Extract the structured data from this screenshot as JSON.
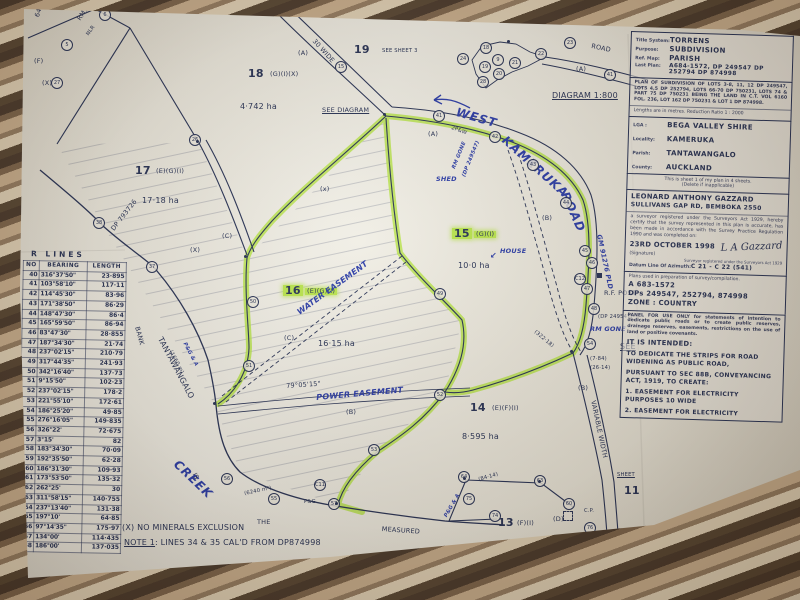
{
  "colors": {
    "ink": "#232e52",
    "pen": "#2638a6",
    "highlight": "#b9e54a",
    "paper": "#edeadf",
    "fabric_dark": "#473628",
    "fabric_tan": "#c8ad8b"
  },
  "title_block": {
    "fields": [
      {
        "label": "Title System:",
        "value": "TORRENS"
      },
      {
        "label": "Purpose:",
        "value": "SUBDIVISION"
      },
      {
        "label": "Ref. Map:",
        "value": "PARISH"
      },
      {
        "label": "Last Plan:",
        "value": "A684-1572, DP 249547 DP 252794  DP 874998"
      }
    ],
    "plan_of_subdivision": "PLAN OF SUBDIVISION OF LOTS 3-8, 11, 12 DP 249547, LOTS 4,5 DP 252794, LOTS 66-70 DP 750231, LOTS 74 & PART 75 DP 750231 BEING THE LAND IN C.T. VOL 6160 FOL. 236, LOT 162 DP 750231 & LOT 1 DP 874998.",
    "lengths_note": "Lengths are in metres.   Reduction Ratio 1 : 2000",
    "admin": [
      {
        "label": "LGA :",
        "value": "BEGA VALLEY SHIRE"
      },
      {
        "label": "Locality:",
        "value": "KAMERUKA"
      },
      {
        "label": "Parish:",
        "value": "TANTAWANGALO"
      },
      {
        "label": "County:",
        "value": "AUCKLAND"
      }
    ],
    "sheet_note": "This is sheet 1 of my plan in 4 sheets.",
    "sheet_note2": "(Delete if inapplicable)",
    "surveyor_name": "LEONARD ANTHONY GAZZARD",
    "surveyor_address": "SULLIVANS GAP RD, BEMBOKA 2550",
    "certification": "a surveyor registered under the Surveyors Act 1929, hereby certify that the survey represented in this plan is accurate, has been made in accordance with the Survey Practice Regulation 1990 and was completed on:",
    "survey_date": "23RD OCTOBER 1998",
    "signature": "L A Gazzard",
    "signature_caption": "(Signature)",
    "registered_note": "Surveyor registered under the Surveyors Act 1929",
    "datum_label": "Datum Line Of Azimuth:",
    "datum_value": "C 21 - C 22 (541)",
    "plans_used_label": "Plans used in preparation of survey/compilation.",
    "plans_used_1": "A 683-1572",
    "plans_used_2": "DPs 249547, 252794, 874998",
    "plans_used_3": "ZONE : COUNTRY",
    "panel_note": "PANEL FOR USE ONLY for statements of intention to dedicate public roads or to create public reserves, drainage reserves, easements, restrictions on the use of land or positive covenants.",
    "intended_title": "IT IS INTENDED:",
    "intended_1": "TO DEDICATE THE STRIPS FOR ROAD WIDENING AS PUBLIC ROAD,",
    "intended_2": "PURSUANT TO SEC 88B, CONVEYANCING ACT, 1919, TO CREATE:",
    "intended_3": "1. EASEMENT FOR ELECTRICITY PURPOSES 10 WIDE",
    "intended_4": "2. EASEMENT FOR ELECTRICITY"
  },
  "lines_table": {
    "title": "R  LINES",
    "columns": [
      "NO",
      "BEARING",
      "LENGTH"
    ],
    "rows": [
      [
        "40",
        "316°37'50\"",
        "23·895"
      ],
      [
        "41",
        "103°58'10\"",
        "117·11"
      ],
      [
        "42",
        "114°45'30\"",
        "83·96"
      ],
      [
        "43",
        "171°38'50\"",
        "86·29"
      ],
      [
        "44",
        "148°47'30\"",
        "86·4"
      ],
      [
        "45",
        "165°59'50\"",
        "86·94"
      ],
      [
        "46",
        "83°47'30\"",
        "28·855"
      ],
      [
        "47",
        "187°34'30\"",
        "21·74"
      ],
      [
        "48",
        "237°02'15\"",
        "210·79"
      ],
      [
        "49",
        "317°44'35\"",
        "241·93"
      ],
      [
        "50",
        "342°16'40\"",
        "137·73"
      ],
      [
        "51",
        "9°15'50\"",
        "102·23"
      ],
      [
        "52",
        "237°02'15\"",
        "178·2"
      ],
      [
        "53",
        "221°55'10\"",
        "172·61"
      ],
      [
        "54",
        "186°25'20\"",
        "49·85"
      ],
      [
        "55",
        "276°16'05\"",
        "149·835"
      ],
      [
        "56",
        "326°22'",
        "72·675"
      ],
      [
        "57",
        "3°15'",
        "82"
      ],
      [
        "58",
        "183°34'30\"",
        "70·09"
      ],
      [
        "59",
        "192°35'50\"",
        "62·28"
      ],
      [
        "60",
        "186°31'30\"",
        "109·93"
      ],
      [
        "61",
        "173°53'50\"",
        "135·32"
      ],
      [
        "62",
        "262°25'",
        "30"
      ],
      [
        "63",
        "311°58'15\"",
        "140·755"
      ],
      [
        "64",
        "237°13'40\"",
        "131·38"
      ],
      [
        "65",
        "197°10'",
        "64·85"
      ],
      [
        "66",
        "97°14'35\"",
        "175·97"
      ],
      [
        "67",
        "134°00'",
        "114·435"
      ],
      [
        "68",
        "186°00'",
        "137·035"
      ]
    ]
  },
  "map": {
    "labels": [
      {
        "t": "6449",
        "x": 34,
        "y": 16,
        "r": -72,
        "c": "sm"
      },
      {
        "t": "RM1",
        "x": 76,
        "y": 18,
        "r": -55,
        "c": "sm"
      },
      {
        "t": "NLR",
        "x": 86,
        "y": 34,
        "r": -55,
        "c": "xs"
      },
      {
        "t": "(F)",
        "x": 34,
        "y": 58,
        "c": "sm"
      },
      {
        "t": "(X)",
        "x": 42,
        "y": 80,
        "c": "sm"
      },
      {
        "t": "19",
        "x": 354,
        "y": 44,
        "c": "big",
        "n": "lot-19-label"
      },
      {
        "t": "SEE SHEET 3",
        "x": 382,
        "y": 49,
        "c": "xs"
      },
      {
        "t": "18",
        "x": 248,
        "y": 68,
        "c": "big",
        "n": "lot-18-label"
      },
      {
        "t": "(G)(I)(X)",
        "x": 270,
        "y": 71,
        "c": "sm"
      },
      {
        "t": "4·742 ha",
        "x": 240,
        "y": 103,
        "c": "md",
        "n": "lot-18-area"
      },
      {
        "t": "SEE DIAGRAM",
        "x": 322,
        "y": 107,
        "c": "sm und"
      },
      {
        "t": "(A)",
        "x": 298,
        "y": 50,
        "c": "sm"
      },
      {
        "t": "30 WIDE",
        "x": 316,
        "y": 38,
        "r": 48,
        "c": "sm"
      },
      {
        "t": "ROAD",
        "x": 592,
        "y": 43,
        "r": 12,
        "c": "sm"
      },
      {
        "t": "(A)",
        "x": 576,
        "y": 66,
        "c": "sm"
      },
      {
        "t": "DIAGRAM 1:800",
        "x": 552,
        "y": 92,
        "c": "md und",
        "n": "inset-diagram-title"
      },
      {
        "t": "17",
        "x": 135,
        "y": 165,
        "c": "big",
        "n": "lot-17-label"
      },
      {
        "t": "(E)(G)(I)",
        "x": 156,
        "y": 168,
        "c": "sm"
      },
      {
        "t": "17·18 ha",
        "x": 142,
        "y": 197,
        "c": "md",
        "n": "lot-17-area"
      },
      {
        "t": "DP 793726",
        "x": 110,
        "y": 228,
        "r": -52,
        "c": "sm"
      },
      {
        "t": "ENING",
        "x": 4,
        "y": 196,
        "r": 80,
        "c": "sm"
      },
      {
        "t": "(x)",
        "x": 320,
        "y": 186,
        "c": "sm"
      },
      {
        "t": "(X)",
        "x": 190,
        "y": 247,
        "c": "sm"
      },
      {
        "t": "WEST",
        "x": 458,
        "y": 106,
        "r": 16,
        "c": "pen pen-lg",
        "n": "road-name-west"
      },
      {
        "t": "KAMERUKA",
        "x": 508,
        "y": 134,
        "r": 42,
        "c": "pen pen-lg",
        "n": "road-name-kameruka"
      },
      {
        "t": "ROAD",
        "x": 570,
        "y": 190,
        "r": 66,
        "c": "pen pen-lg",
        "n": "road-name-road"
      },
      {
        "t": "SHED",
        "x": 436,
        "y": 176,
        "c": "pen pen-sm"
      },
      {
        "t": "RM GONE",
        "x": 452,
        "y": 168,
        "r": -68,
        "c": "pen pen-xs"
      },
      {
        "t": "(DP 249547)",
        "x": 462,
        "y": 176,
        "r": -68,
        "c": "pen pen-xs"
      },
      {
        "t": "2P&W",
        "x": 452,
        "y": 126,
        "r": 20,
        "c": "xs"
      },
      {
        "t": "15",
        "x": 452,
        "y": 228,
        "c": "big hl",
        "n": "lot-15-label"
      },
      {
        "t": "(G)(I)",
        "x": 474,
        "y": 231,
        "c": "sm hl"
      },
      {
        "t": "10·0 ha",
        "x": 458,
        "y": 262,
        "c": "md",
        "n": "lot-15-area"
      },
      {
        "t": "HOUSE",
        "x": 500,
        "y": 248,
        "c": "pen pen-sm",
        "n": "house-annotation"
      },
      {
        "t": "↙",
        "x": 490,
        "y": 252,
        "c": "pen pen-md"
      },
      {
        "t": "(B)",
        "x": 542,
        "y": 215,
        "c": "sm"
      },
      {
        "t": "16",
        "x": 283,
        "y": 285,
        "c": "big hl",
        "n": "lot-16-label"
      },
      {
        "t": "(E)(G)(I)",
        "x": 305,
        "y": 288,
        "c": "sm hl"
      },
      {
        "t": "16·15 ha",
        "x": 318,
        "y": 340,
        "c": "md",
        "n": "lot-16-area"
      },
      {
        "t": "WATER EASEMENT",
        "x": 296,
        "y": 310,
        "r": -36,
        "c": "pen pen-md",
        "n": "water-easement-annotation"
      },
      {
        "t": "(C)",
        "x": 284,
        "y": 335,
        "c": "sm"
      },
      {
        "t": "(C)",
        "x": 222,
        "y": 233,
        "c": "sm"
      },
      {
        "t": "79°05'15\"",
        "x": 286,
        "y": 383,
        "r": -4,
        "c": "sm"
      },
      {
        "t": "POWER EASEMENT",
        "x": 316,
        "y": 394,
        "r": -5,
        "c": "pen pen-md",
        "n": "power-easement-annotation"
      },
      {
        "t": "(B)",
        "x": 346,
        "y": 409,
        "c": "sm"
      },
      {
        "t": "14",
        "x": 470,
        "y": 402,
        "c": "big",
        "n": "lot-14-label"
      },
      {
        "t": "(E)(F)(I)",
        "x": 492,
        "y": 405,
        "c": "sm"
      },
      {
        "t": "8·595 ha",
        "x": 462,
        "y": 433,
        "c": "md",
        "n": "lot-14-area"
      },
      {
        "t": "13",
        "x": 498,
        "y": 517,
        "c": "big",
        "n": "lot-13-label"
      },
      {
        "t": "(F)(I)",
        "x": 517,
        "y": 520,
        "c": "sm"
      },
      {
        "t": "(D)",
        "x": 553,
        "y": 516,
        "c": "sm"
      },
      {
        "t": "TANTAWANGALO",
        "x": 163,
        "y": 336,
        "r": 62,
        "c": "md",
        "n": "creek-name"
      },
      {
        "t": "CREEK",
        "x": 180,
        "y": 458,
        "r": 44,
        "c": "pen pen-lg",
        "n": "creek-name-pen"
      },
      {
        "t": "BANK",
        "x": 140,
        "y": 326,
        "r": 75,
        "c": "sm"
      },
      {
        "t": "(1660 m)",
        "x": 172,
        "y": 350,
        "r": 62,
        "c": "xs"
      },
      {
        "t": "P&G & A",
        "x": 186,
        "y": 342,
        "r": 62,
        "c": "pen pen-xs"
      },
      {
        "t": "IS",
        "x": 197,
        "y": 472,
        "r": 65,
        "c": "sm"
      },
      {
        "t": "THE",
        "x": 257,
        "y": 519,
        "c": "sm"
      },
      {
        "t": "MEASURED",
        "x": 382,
        "y": 526,
        "r": 4,
        "c": "sm"
      },
      {
        "t": "(6240 m²)",
        "x": 244,
        "y": 492,
        "r": -12,
        "c": "xs"
      },
      {
        "t": "P&G",
        "x": 304,
        "y": 500,
        "c": "xs"
      },
      {
        "t": "(X) NO MINERALS EXCLUSION",
        "x": 122,
        "y": 524,
        "c": "md",
        "n": "minerals-note"
      },
      {
        "t": "NOTE 1",
        "x": 124,
        "y": 539,
        "c": "md und",
        "n": "note-1"
      },
      {
        "t": ": LINES 34 & 35 CAL'D FROM DP874998",
        "x": 155,
        "y": 539,
        "c": "md"
      },
      {
        "t": "GM 91276 PLD",
        "x": 602,
        "y": 234,
        "r": 78,
        "c": "pen pen-sm"
      },
      {
        "t": "R.F. POST",
        "x": 604,
        "y": 290,
        "c": "sm"
      },
      {
        "t": "(DP 249547)",
        "x": 598,
        "y": 315,
        "c": "xs"
      },
      {
        "t": "RM GONE",
        "x": 590,
        "y": 326,
        "c": "pen pen-sm"
      },
      {
        "t": "SEE",
        "x": 620,
        "y": 343,
        "c": "md und"
      },
      {
        "t": "(7·84)",
        "x": 590,
        "y": 357,
        "c": "xs"
      },
      {
        "t": "(26·14)",
        "x": 590,
        "y": 366,
        "c": "xs"
      },
      {
        "t": "(B)",
        "x": 578,
        "y": 385,
        "c": "sm"
      },
      {
        "t": "(322·18)",
        "x": 536,
        "y": 330,
        "r": 40,
        "c": "xs"
      },
      {
        "t": "VARIABLE WIDTH",
        "x": 596,
        "y": 400,
        "r": 78,
        "c": "sm",
        "n": "road-width-note"
      },
      {
        "t": "(84·14)",
        "x": 478,
        "y": 478,
        "r": -16,
        "c": "xs"
      },
      {
        "t": "P&G & A",
        "x": 444,
        "y": 516,
        "r": -60,
        "c": "pen pen-xs"
      },
      {
        "t": "C.P.",
        "x": 584,
        "y": 509,
        "c": "xs"
      },
      {
        "t": "RM GONE",
        "x": 586,
        "y": 538,
        "c": "sm"
      },
      {
        "t": "SHEET",
        "x": 617,
        "y": 473,
        "c": "xs und"
      },
      {
        "t": "11",
        "x": 624,
        "y": 485,
        "c": "big",
        "n": "sheet-11-label"
      },
      {
        "t": "(A)",
        "x": 428,
        "y": 131,
        "c": "sm"
      }
    ],
    "circles": [
      {
        "n": "5",
        "x": 66,
        "y": 44
      },
      {
        "n": "6",
        "x": 104,
        "y": 14
      },
      {
        "n": "27",
        "x": 56,
        "y": 82
      },
      {
        "n": "26",
        "x": 194,
        "y": 139
      },
      {
        "n": "38",
        "x": 98,
        "y": 222
      },
      {
        "n": "37",
        "x": 151,
        "y": 266
      },
      {
        "n": "15",
        "x": 340,
        "y": 66
      },
      {
        "n": "18",
        "x": 485,
        "y": 47
      },
      {
        "n": "24",
        "x": 462,
        "y": 58
      },
      {
        "n": "9",
        "x": 497,
        "y": 59
      },
      {
        "n": "19",
        "x": 484,
        "y": 66
      },
      {
        "n": "20",
        "x": 498,
        "y": 73
      },
      {
        "n": "28",
        "x": 482,
        "y": 81
      },
      {
        "n": "21",
        "x": 514,
        "y": 62
      },
      {
        "n": "22",
        "x": 540,
        "y": 53
      },
      {
        "n": "23",
        "x": 569,
        "y": 42
      },
      {
        "n": "41",
        "x": 609,
        "y": 74
      },
      {
        "n": "41",
        "x": 438,
        "y": 115
      },
      {
        "n": "42",
        "x": 494,
        "y": 136
      },
      {
        "n": "43",
        "x": 532,
        "y": 164
      },
      {
        "n": "44",
        "x": 565,
        "y": 202
      },
      {
        "n": "45",
        "x": 584,
        "y": 250
      },
      {
        "n": "46",
        "x": 591,
        "y": 262
      },
      {
        "n": "C12",
        "x": 579,
        "y": 278
      },
      {
        "n": "47",
        "x": 586,
        "y": 288
      },
      {
        "n": "48",
        "x": 593,
        "y": 308
      },
      {
        "n": "54",
        "x": 589,
        "y": 343
      },
      {
        "n": "49",
        "x": 439,
        "y": 293
      },
      {
        "n": "50",
        "x": 252,
        "y": 301
      },
      {
        "n": "51",
        "x": 248,
        "y": 365
      },
      {
        "n": "52",
        "x": 439,
        "y": 394
      },
      {
        "n": "53",
        "x": 373,
        "y": 449
      },
      {
        "n": "56",
        "x": 226,
        "y": 478
      },
      {
        "n": "55",
        "x": 273,
        "y": 498
      },
      {
        "n": "C11",
        "x": 319,
        "y": 484
      },
      {
        "n": "57",
        "x": 333,
        "y": 503
      },
      {
        "n": "64",
        "x": 463,
        "y": 476
      },
      {
        "n": "63",
        "x": 539,
        "y": 480
      },
      {
        "n": "75",
        "x": 468,
        "y": 498
      },
      {
        "n": "74",
        "x": 494,
        "y": 515
      },
      {
        "n": "60",
        "x": 568,
        "y": 503
      },
      {
        "n": "76",
        "x": 589,
        "y": 527
      }
    ],
    "marks": [
      {
        "type": "dot",
        "x": 386,
        "y": 116
      },
      {
        "type": "dot",
        "x": 573,
        "y": 353
      },
      {
        "type": "dot",
        "x": 216,
        "y": 405
      },
      {
        "type": "dot",
        "x": 338,
        "y": 505
      },
      {
        "type": "dot",
        "x": 466,
        "y": 480
      },
      {
        "type": "dot",
        "x": 541,
        "y": 483
      },
      {
        "type": "dot",
        "x": 247,
        "y": 258
      },
      {
        "type": "dot",
        "x": 199,
        "y": 143
      },
      {
        "type": "dot",
        "x": 510,
        "y": 43
      },
      {
        "type": "square",
        "x": 600,
        "y": 276
      },
      {
        "type": "dsquare",
        "x": 566,
        "y": 514
      }
    ]
  }
}
